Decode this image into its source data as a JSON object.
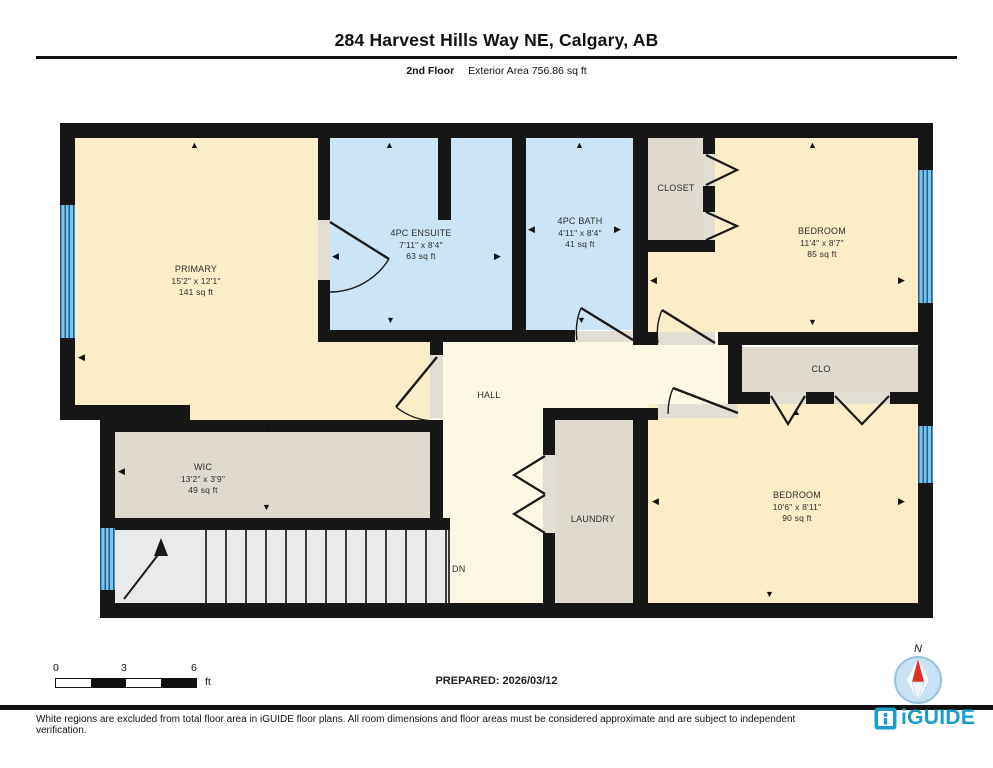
{
  "header": {
    "title": "284 Harvest Hills Way NE, Calgary, AB",
    "floor_label": "2nd Floor",
    "area_label": "Exterior Area 756.86 sq ft"
  },
  "rooms": {
    "primary": {
      "name": "PRIMARY",
      "dims": "15'2\" x 12'1\"",
      "area": "141 sq ft"
    },
    "ensuite": {
      "name": "4PC ENSUITE",
      "dims": "7'11\" x 8'4\"",
      "area": "63 sq ft"
    },
    "bath": {
      "name": "4PC BATH",
      "dims": "4'11\" x 8'4\"",
      "area": "41 sq ft"
    },
    "closet": {
      "name": "CLOSET"
    },
    "bedroom_top": {
      "name": "BEDROOM",
      "dims": "11'4\" x 8'7\"",
      "area": "85 sq ft"
    },
    "hall": {
      "name": "HALL"
    },
    "clo": {
      "name": "CLO"
    },
    "wic": {
      "name": "WIC",
      "dims": "13'2\" x 3'9\"",
      "area": "49 sq ft"
    },
    "laundry": {
      "name": "LAUNDRY"
    },
    "bedroom_bottom": {
      "name": "BEDROOM",
      "dims": "10'6\" x 8'11\"",
      "area": "90 sq ft"
    },
    "stairs": {
      "label": "DN"
    }
  },
  "scale_bar": {
    "start": "0",
    "mid": "3",
    "end": "6",
    "unit": "ft"
  },
  "compass": {
    "label": "N"
  },
  "footer": {
    "prepared": "PREPARED: 2026/03/12",
    "disclaimer": "White regions are excluded from total floor area in iGUIDE floor plans. All room dimensions and floor areas must be considered approximate and are subject to independent verification.",
    "brand": "iGUIDE"
  },
  "colors": {
    "wall": "#161616",
    "room_cream": "#FAEDC8",
    "room_light_cream": "#FDF8E3",
    "room_grey": "#DFD9CE",
    "room_blue": "#CBE5F6",
    "stairs_grey": "#EAEAEA",
    "window_blue": "#7EC3EA",
    "brand_blue": "#1B9DC9",
    "compass_red": "#E03023"
  }
}
